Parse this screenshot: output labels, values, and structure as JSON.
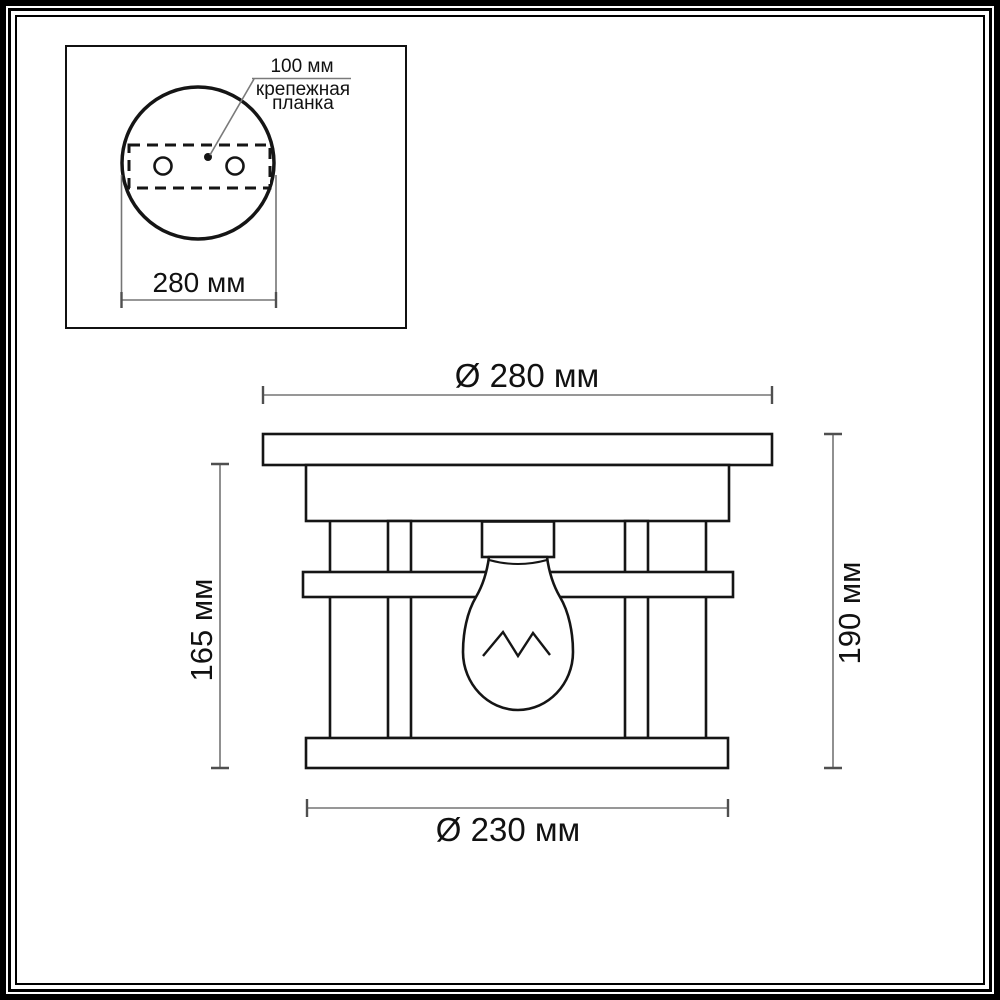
{
  "inset": {
    "leader_label": "100 мм",
    "note_line1": "крепежная",
    "note_line2": "планка",
    "width_label": "280 мм"
  },
  "dimensions": {
    "top": "Ø 280 мм",
    "bottom": "Ø 230 мм",
    "left": "165 мм",
    "right": "190 мм"
  },
  "colors": {
    "line": "#151515",
    "dim_line": "#757575",
    "dim_tick": "#4f4f4f",
    "leader": "#7a7a7a"
  }
}
